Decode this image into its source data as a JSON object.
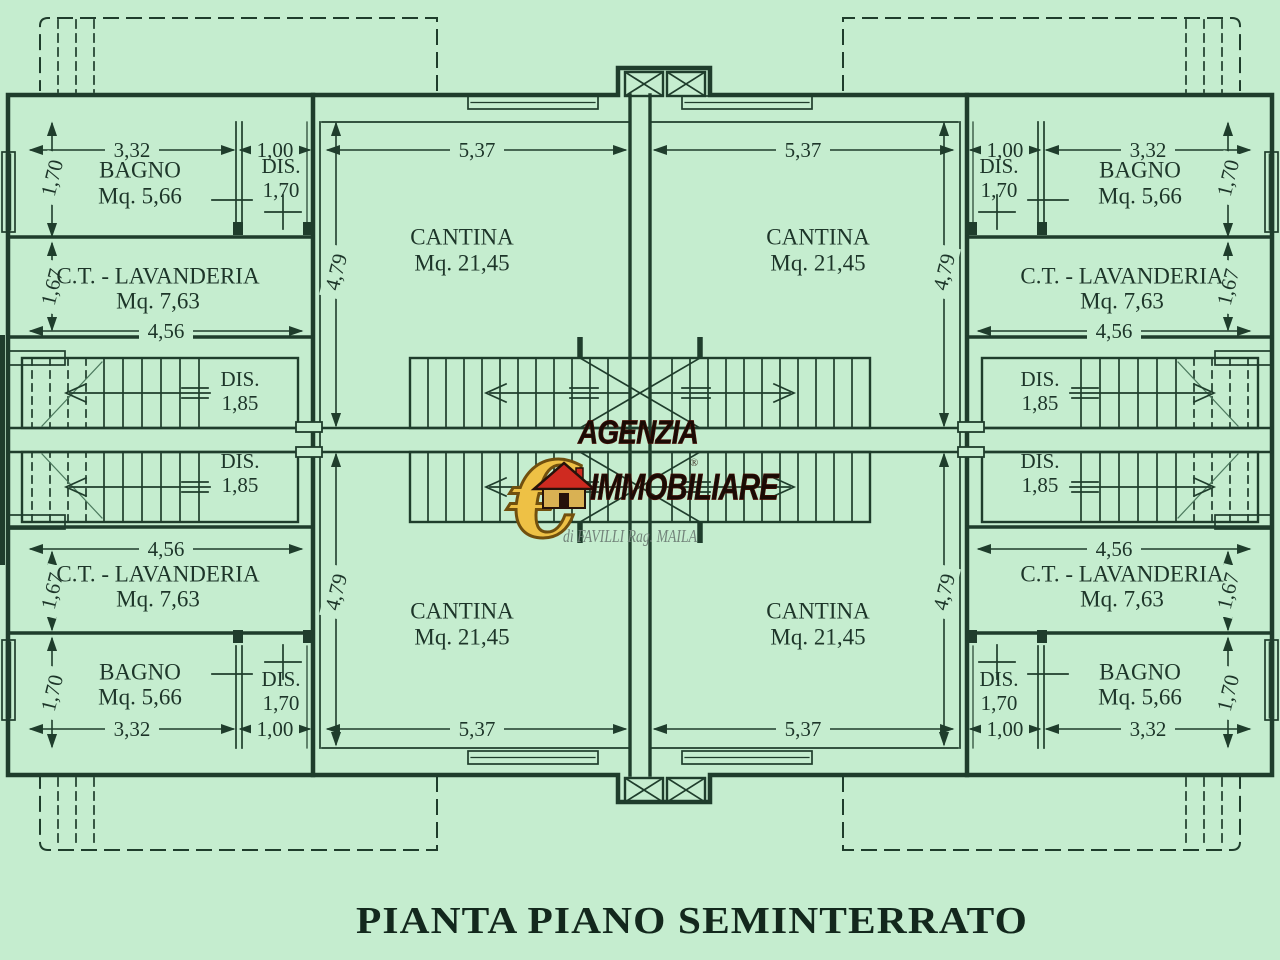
{
  "title": "PIANTA PIANO SEMINTERRATO",
  "watermark": {
    "agency_line1": "AGENZIA",
    "agency_line2": "IMMOBILIARE",
    "tagline": "di FAVILLI Rag. MAILA",
    "euro_symbol": "€",
    "registered": "®"
  },
  "rooms": {
    "bagno": {
      "name": "BAGNO",
      "area": "Mq. 5,66"
    },
    "dis": {
      "name": "DIS.",
      "height": "1,70"
    },
    "ct_lavanderia": {
      "name": "C.T. - LAVANDERIA",
      "area": "Mq. 7,63"
    },
    "dis_corridoio": {
      "name": "DIS.",
      "width": "1,85"
    },
    "cantina": {
      "name": "CANTINA",
      "area": "Mq. 21,45"
    }
  },
  "dimensions": {
    "bagno_width": "3,32",
    "dis_width": "1,00",
    "cantina_width": "5,37",
    "bagno_depth": "1,70",
    "ct_depth": "1,67",
    "ct_width": "4,56",
    "cantina_depth": "4,79"
  },
  "colors": {
    "background": "#c5edcf",
    "line": "#1f3d2c",
    "text": "#1d3529",
    "logo_black": "#190b05",
    "logo_gold": "#eec145",
    "roof_red": "#cf2a20",
    "signature": "#72837a"
  }
}
